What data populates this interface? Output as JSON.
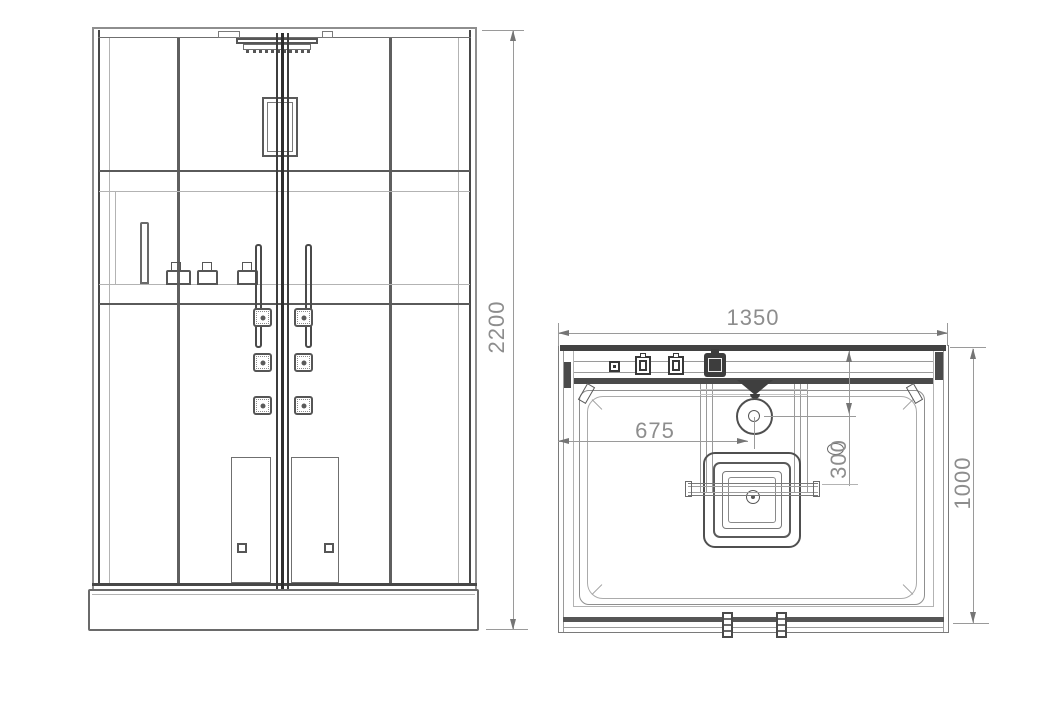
{
  "drawing": {
    "front_view": {
      "name": "front elevation of shower cabin",
      "height_label": "2200"
    },
    "plan_view": {
      "name": "top plan of shower tray",
      "width_label": "1350",
      "depth_label": "1000",
      "center_offset_label": "675",
      "head_depth_label": "300"
    },
    "colors": {
      "line_dark": "#474747",
      "line_light": "#b3b3b3",
      "dimension": "#9a9a9a",
      "text": "#8d8d8d"
    }
  }
}
